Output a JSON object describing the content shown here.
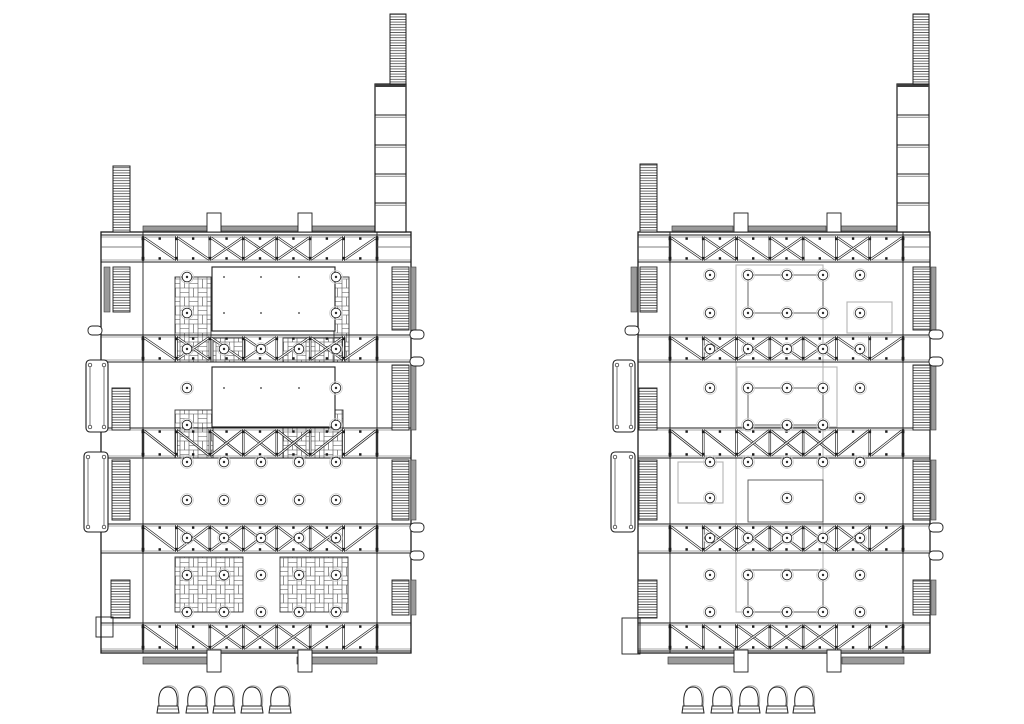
{
  "canvas": {
    "width": 1024,
    "height": 724,
    "background": "#ffffff"
  },
  "palette": {
    "ink": "#1c1c1c",
    "mid": "#555555",
    "bar_fill": "#9a9a9a",
    "bar_edge": "#3d3d3d",
    "light_outline": "#b4b4b4",
    "halo": "#cfcfcf",
    "echo": "#a8a8a8",
    "white": "#ffffff"
  },
  "icons": {
    "bollard_icon": "dome-bollard",
    "stair_hatch_icon": "ladder-hatch",
    "paving_icon": "basketweave-hatch",
    "column_icon": "circle-with-dot",
    "truss_icon": "x-braced-truss-band"
  },
  "bollards": {
    "top_y": 687,
    "left_centers_x": [
      168,
      197,
      224,
      252,
      280
    ],
    "right_centers_x": [
      693,
      722,
      749,
      777,
      804
    ]
  },
  "plans": [
    {
      "name": "plan-left",
      "body": {
        "x1": 101,
        "x2": 411,
        "y1": 232,
        "y2": 653,
        "chord_left": 143,
        "chord_right": 377,
        "corner_split_y": 247
      },
      "truss_bands": [
        {
          "y1": 235,
          "y2": 262,
          "pattern": [
            "d",
            "d",
            "x",
            "x",
            "x",
            "u",
            "u"
          ]
        },
        {
          "y1": 335,
          "y2": 362,
          "pattern": [
            "d",
            "x",
            "d",
            "x",
            "u",
            "x",
            "u"
          ]
        },
        {
          "y1": 428,
          "y2": 458,
          "pattern": [
            "d",
            "d",
            "x",
            "x",
            "x",
            "u",
            "u"
          ]
        },
        {
          "y1": 524,
          "y2": 553,
          "pattern": [
            "d",
            "x",
            "x",
            "x",
            "x",
            "x",
            "u"
          ]
        },
        {
          "y1": 623,
          "y2": 651,
          "pattern": [
            "d",
            "d",
            "x",
            "x",
            "x",
            "u",
            "u"
          ]
        }
      ],
      "tower_right": {
        "shaft_x1": 375,
        "shaft_x2": 406,
        "top_y": 84,
        "dividers": [
          115,
          145,
          174,
          203
        ],
        "cap_x1": 390,
        "cap_x2": 406,
        "cap_y1": 14
      },
      "tower_left": {
        "x1": 113,
        "x2": 130,
        "y1": 166
      },
      "top_bars": [
        {
          "x": 143,
          "w": 65
        },
        {
          "x": 221,
          "w": 77
        },
        {
          "x": 312,
          "w": 65
        }
      ],
      "top_tabs": [
        {
          "x": 207,
          "w": 14
        },
        {
          "x": 298,
          "w": 14
        }
      ],
      "bottom_bars": [
        {
          "x": 143,
          "w": 66
        },
        {
          "x": 297,
          "w": 80
        }
      ],
      "bottom_tabs": [
        {
          "x": 207,
          "w": 14
        },
        {
          "x": 298,
          "w": 14
        }
      ],
      "stairs": [
        {
          "x": 113,
          "y": 267,
          "w": 17,
          "h": 45
        },
        {
          "x": 112,
          "y": 388,
          "w": 18,
          "h": 42
        },
        {
          "x": 112,
          "y": 460,
          "w": 18,
          "h": 60
        },
        {
          "x": 111,
          "y": 580,
          "w": 19,
          "h": 38
        },
        {
          "x": 392,
          "y": 267,
          "w": 17,
          "h": 63
        },
        {
          "x": 392,
          "y": 365,
          "w": 17,
          "h": 65
        },
        {
          "x": 392,
          "y": 460,
          "w": 17,
          "h": 60
        },
        {
          "x": 392,
          "y": 580,
          "w": 17,
          "h": 35
        }
      ],
      "side_bars": [
        {
          "x": 104,
          "y": 267,
          "w": 6,
          "h": 45
        },
        {
          "x": 411,
          "y": 267,
          "w": 5,
          "h": 63
        },
        {
          "x": 411,
          "y": 365,
          "w": 5,
          "h": 65
        },
        {
          "x": 411,
          "y": 460,
          "w": 5,
          "h": 60
        },
        {
          "x": 411,
          "y": 580,
          "w": 5,
          "h": 35
        }
      ],
      "lifts": [
        {
          "x": 86,
          "y": 360,
          "w": 22,
          "h": 72
        },
        {
          "x": 84,
          "y": 452,
          "w": 24,
          "h": 80
        }
      ],
      "pills_left_y": [
        326
      ],
      "pills_right_y": [
        330,
        357,
        523,
        551
      ],
      "corner_box": {
        "x": 96,
        "y": 617,
        "w": 17,
        "h": 20
      },
      "columns": {
        "xs": [
          187,
          224,
          261,
          299,
          336
        ],
        "rows": [
          {
            "y": 277,
            "cols": [
              0,
              4
            ]
          },
          {
            "y": 313,
            "cols": [
              0,
              4
            ]
          },
          {
            "y": 349,
            "cols": [
              0,
              1,
              2,
              3,
              4
            ]
          },
          {
            "y": 388,
            "cols": [
              0,
              4
            ]
          },
          {
            "y": 425,
            "cols": [
              0,
              4
            ]
          },
          {
            "y": 462,
            "cols": [
              0,
              1,
              2,
              3,
              4
            ]
          },
          {
            "y": 500,
            "cols": [
              0,
              1,
              2,
              3,
              4
            ]
          },
          {
            "y": 538,
            "cols": [
              0,
              1,
              2,
              3,
              4
            ]
          },
          {
            "y": 575,
            "cols": [
              0,
              1,
              2,
              3,
              4
            ]
          },
          {
            "y": 612,
            "cols": [
              0,
              1,
              2,
              3,
              4
            ]
          }
        ]
      },
      "white_rects": [
        {
          "x": 212,
          "y": 267,
          "w": 123,
          "h": 64,
          "dot_rows": [
            277,
            313
          ]
        },
        {
          "x": 212,
          "y": 367,
          "w": 123,
          "h": 60,
          "dot_rows": [
            388
          ]
        }
      ],
      "weave_rects": [
        {
          "x": 175,
          "y": 277,
          "w": 36,
          "h": 85
        },
        {
          "x": 334,
          "y": 277,
          "w": 15,
          "h": 85
        },
        {
          "x": 213,
          "y": 338,
          "w": 32,
          "h": 24
        },
        {
          "x": 283,
          "y": 338,
          "w": 62,
          "h": 24
        },
        {
          "x": 175,
          "y": 410,
          "w": 38,
          "h": 48
        },
        {
          "x": 283,
          "y": 410,
          "w": 60,
          "h": 48
        },
        {
          "x": 175,
          "y": 557,
          "w": 68,
          "h": 55
        },
        {
          "x": 280,
          "y": 557,
          "w": 68,
          "h": 55
        }
      ],
      "outline_rects_light": [],
      "outline_rects_dark": []
    },
    {
      "name": "plan-right",
      "body": {
        "x1": 638,
        "x2": 930,
        "y1": 232,
        "y2": 653,
        "chord_left": 670,
        "chord_right": 903,
        "corner_split_y": 247
      },
      "truss_bands": [
        {
          "y1": 235,
          "y2": 262,
          "pattern": [
            "d",
            "x",
            "d",
            "x",
            "d",
            "x",
            "u"
          ]
        },
        {
          "y1": 335,
          "y2": 362,
          "pattern": [
            "d",
            "x",
            "x",
            "x",
            "x",
            "d",
            "u"
          ]
        },
        {
          "y1": 428,
          "y2": 458,
          "pattern": [
            "d",
            "d",
            "x",
            "x",
            "x",
            "u",
            "u"
          ]
        },
        {
          "y1": 524,
          "y2": 553,
          "pattern": [
            "d",
            "x",
            "x",
            "x",
            "x",
            "x",
            "u"
          ]
        },
        {
          "y1": 623,
          "y2": 651,
          "pattern": [
            "d",
            "d",
            "x",
            "x",
            "x",
            "u",
            "u"
          ]
        }
      ],
      "tower_right": {
        "shaft_x1": 897,
        "shaft_x2": 929,
        "top_y": 84,
        "dividers": [
          115,
          145,
          174,
          203
        ],
        "cap_x1": 913,
        "cap_x2": 929,
        "cap_y1": 14
      },
      "tower_left": {
        "x1": 640,
        "x2": 657,
        "y1": 164
      },
      "top_bars": [
        {
          "x": 672,
          "w": 61
        },
        {
          "x": 748,
          "w": 78
        },
        {
          "x": 841,
          "w": 60
        }
      ],
      "top_tabs": [
        {
          "x": 734,
          "w": 14
        },
        {
          "x": 827,
          "w": 14
        }
      ],
      "bottom_bars": [
        {
          "x": 668,
          "w": 66
        },
        {
          "x": 842,
          "w": 62
        }
      ],
      "bottom_tabs": [
        {
          "x": 734,
          "w": 14
        },
        {
          "x": 827,
          "w": 14
        }
      ],
      "stairs": [
        {
          "x": 640,
          "y": 267,
          "w": 17,
          "h": 45
        },
        {
          "x": 639,
          "y": 388,
          "w": 18,
          "h": 42
        },
        {
          "x": 639,
          "y": 460,
          "w": 18,
          "h": 60
        },
        {
          "x": 638,
          "y": 580,
          "w": 19,
          "h": 38
        },
        {
          "x": 913,
          "y": 267,
          "w": 17,
          "h": 63
        },
        {
          "x": 913,
          "y": 365,
          "w": 17,
          "h": 65
        },
        {
          "x": 913,
          "y": 460,
          "w": 17,
          "h": 60
        },
        {
          "x": 913,
          "y": 580,
          "w": 17,
          "h": 35
        }
      ],
      "side_bars": [
        {
          "x": 631,
          "y": 267,
          "w": 6,
          "h": 45
        },
        {
          "x": 931,
          "y": 267,
          "w": 5,
          "h": 63
        },
        {
          "x": 931,
          "y": 365,
          "w": 5,
          "h": 65
        },
        {
          "x": 931,
          "y": 460,
          "w": 5,
          "h": 60
        },
        {
          "x": 931,
          "y": 580,
          "w": 5,
          "h": 35
        }
      ],
      "lifts": [
        {
          "x": 613,
          "y": 360,
          "w": 22,
          "h": 72
        },
        {
          "x": 611,
          "y": 452,
          "w": 24,
          "h": 80
        }
      ],
      "pills_left_y": [
        326
      ],
      "pills_right_y": [
        330,
        357,
        523,
        551
      ],
      "corner_box": {
        "x": 622,
        "y": 618,
        "w": 18,
        "h": 36
      },
      "columns": {
        "xs": [
          710,
          748,
          787,
          823,
          860
        ],
        "rows": [
          {
            "y": 275,
            "cols": [
              0,
              1,
              2,
              3,
              4
            ]
          },
          {
            "y": 313,
            "cols": [
              0,
              1,
              2,
              3,
              4
            ]
          },
          {
            "y": 349,
            "cols": [
              0,
              1,
              2,
              3,
              4
            ]
          },
          {
            "y": 388,
            "cols": [
              0,
              1,
              2,
              3,
              4
            ]
          },
          {
            "y": 425,
            "cols": [
              1,
              2,
              3
            ]
          },
          {
            "y": 462,
            "cols": [
              0,
              1,
              2,
              3,
              4
            ]
          },
          {
            "y": 498,
            "cols": [
              0,
              2,
              4
            ]
          },
          {
            "y": 538,
            "cols": [
              0,
              1,
              2,
              3,
              4
            ]
          },
          {
            "y": 575,
            "cols": [
              0,
              1,
              2,
              3,
              4
            ]
          },
          {
            "y": 612,
            "cols": [
              0,
              1,
              2,
              3,
              4
            ]
          }
        ]
      },
      "white_rects": [],
      "weave_rects": [],
      "outline_rects_light": [
        {
          "x": 736,
          "y": 265,
          "w": 87,
          "h": 347
        },
        {
          "x": 737,
          "y": 367,
          "w": 100,
          "h": 60
        },
        {
          "x": 678,
          "y": 462,
          "w": 45,
          "h": 41
        },
        {
          "x": 847,
          "y": 302,
          "w": 45,
          "h": 31
        }
      ],
      "outline_rects_dark": [
        {
          "x": 748,
          "y": 275,
          "w": 75,
          "h": 38
        },
        {
          "x": 748,
          "y": 388,
          "w": 75,
          "h": 37
        },
        {
          "x": 748,
          "y": 480,
          "w": 75,
          "h": 42
        },
        {
          "x": 748,
          "y": 570,
          "w": 75,
          "h": 42
        }
      ]
    }
  ]
}
